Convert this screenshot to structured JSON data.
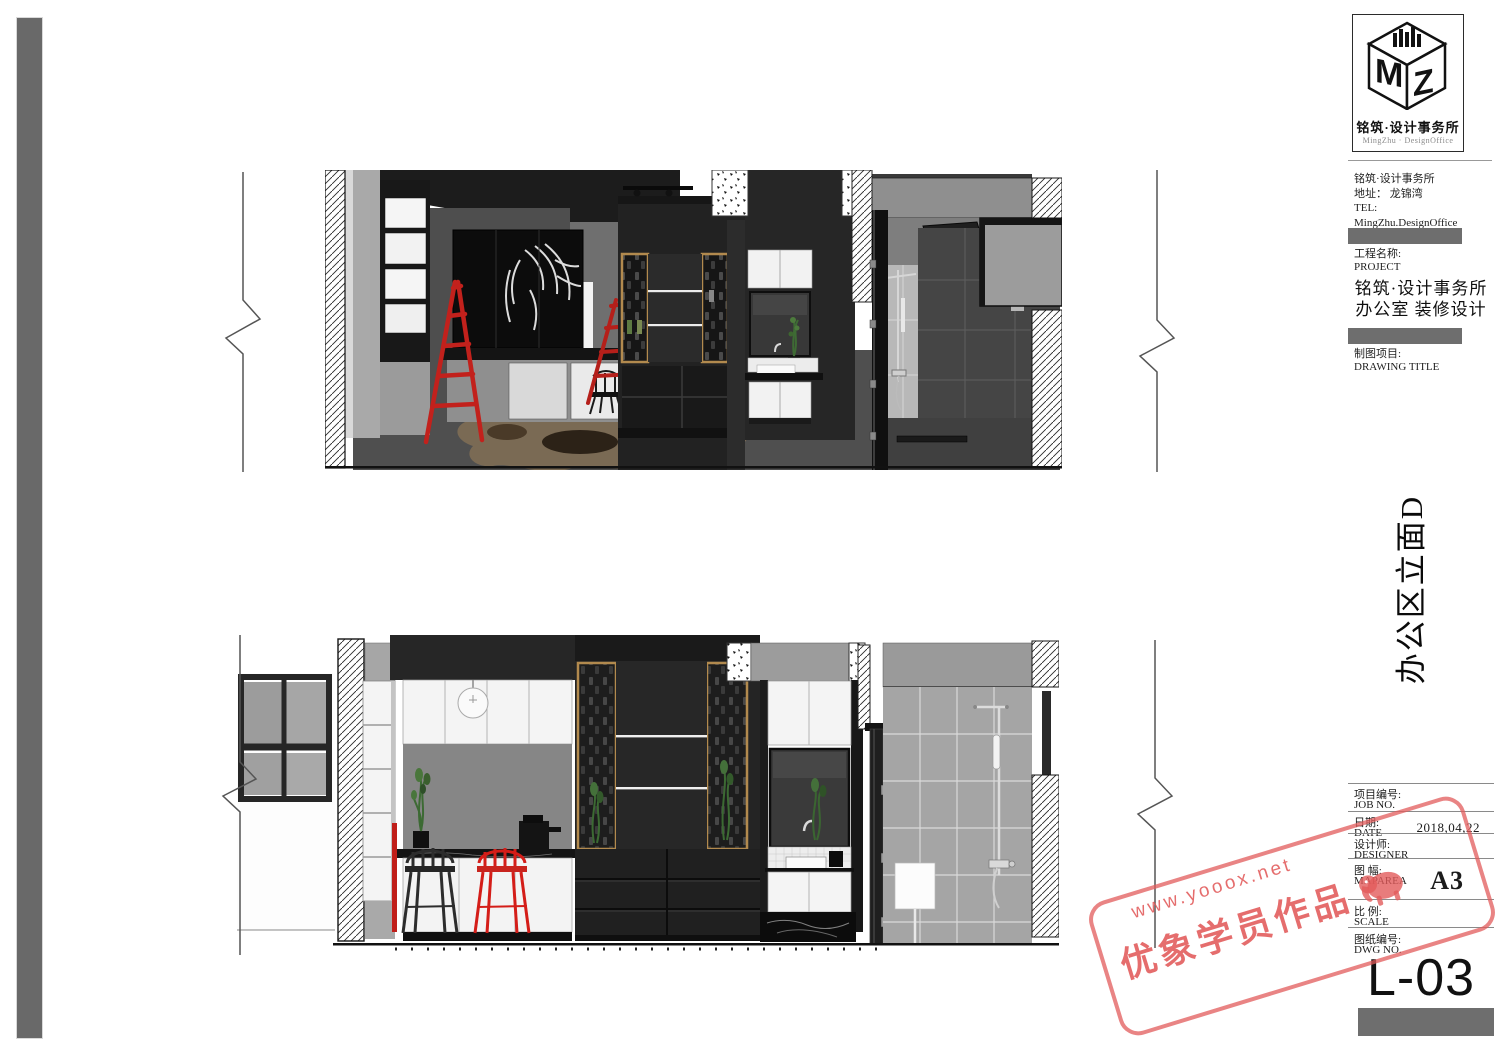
{
  "titleblock": {
    "logo": {
      "monogram_left": "M",
      "monogram_right": "Z",
      "name_cn": "铭筑·设计事务所",
      "name_en": "MingZhu · DesignOffice"
    },
    "company": {
      "line1": "铭筑·设计事务所",
      "line2": "地址： 龙锦湾",
      "line3": "TEL:",
      "line4": "MingZhu.DesignOffice"
    },
    "project": {
      "label_cn": "工程名称:",
      "label_en": "PROJECT",
      "name_line1": "铭筑·设计事务所",
      "name_line2": "办公室 装修设计"
    },
    "drawing": {
      "label_cn": "制图项目:",
      "label_en": "DRAWING TITLE",
      "title": "办公区立面D"
    },
    "fields": [
      {
        "cn": "项目编号:",
        "en": "JOB NO.",
        "value": ""
      },
      {
        "cn": "日期:",
        "en": "DATE",
        "value": "2018,04,22"
      },
      {
        "cn": "设计师:",
        "en": "DESIGNER",
        "value": ""
      },
      {
        "cn": "图 幅:",
        "en": "MAPAREA",
        "value": "A3"
      },
      {
        "cn": "比 例:",
        "en": "SCALE",
        "value": ""
      },
      {
        "cn": "图纸编号:",
        "en": "DWG NO.",
        "value": ""
      }
    ],
    "sheet_number": "L-03"
  },
  "watermark": {
    "url": "www.yooox.net",
    "text": "优象学员作品"
  },
  "colors": {
    "accent_red": "#c2211c",
    "gold_frame": "#b28a4e",
    "stamp_red": "#e25b5b",
    "bar_gray": "#696969",
    "charcoal": "#242424",
    "tile_gray": "#a5a5a5"
  }
}
